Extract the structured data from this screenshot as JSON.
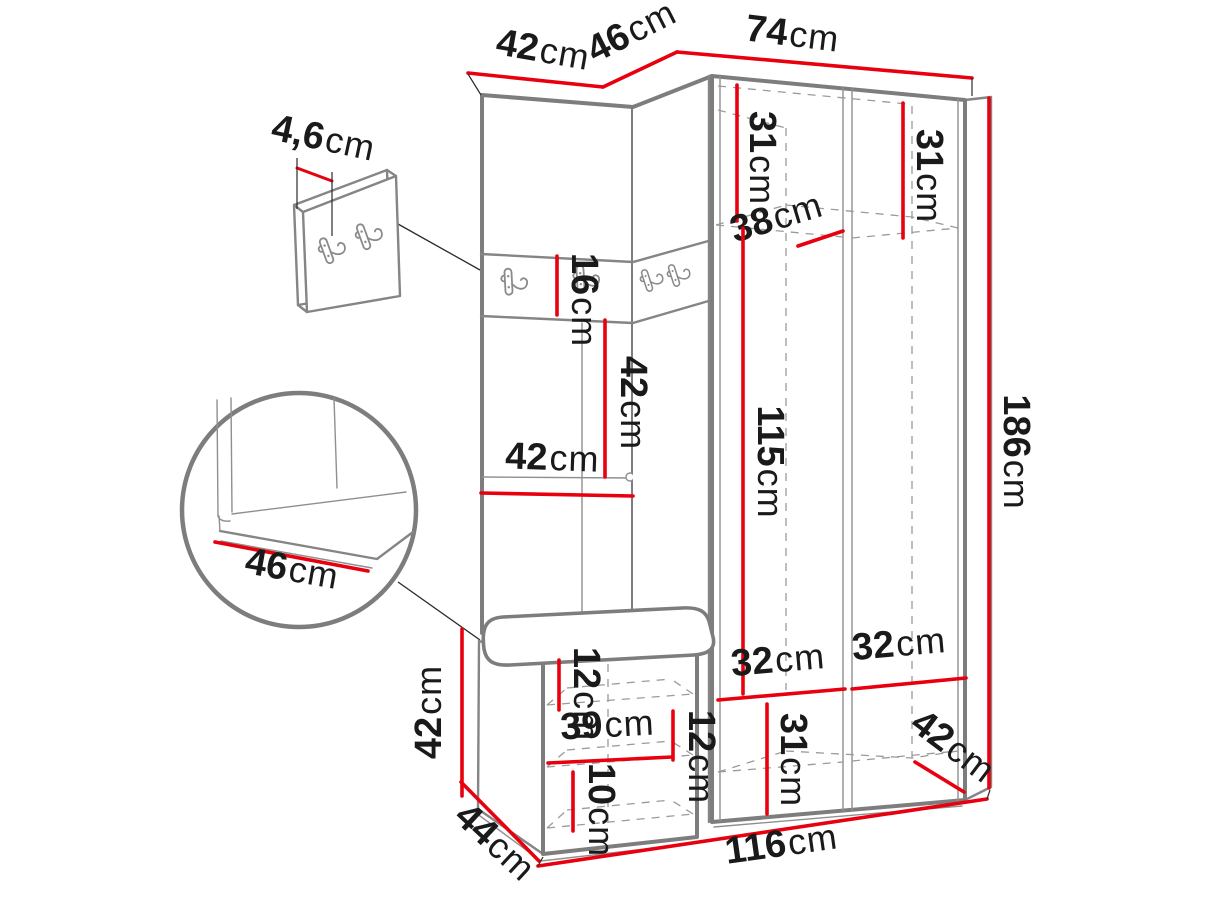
{
  "page": {
    "background": "#ffffff"
  },
  "colors": {
    "dimension_line": "#e8000f",
    "outline_gray": "#7d7d7d",
    "dashed_gray": "#9b9b9b",
    "label_text": "#1a1a1a"
  },
  "diagram": {
    "type": "furniture-dimension-drawing",
    "subject": "corner hallway wardrobe with coat hooks, padded back panel, seat bench and shoe cabinet",
    "units": "cm",
    "dimensions": {
      "top_left_width": {
        "value": "42",
        "unit": "cm"
      },
      "top_corner_width": {
        "value": "46",
        "unit": "cm"
      },
      "top_right_width": {
        "value": "74",
        "unit": "cm"
      },
      "hook_panel_thickness": {
        "value": "4,6",
        "unit": "cm"
      },
      "upper_shelf_left_height": {
        "value": "31",
        "unit": "cm"
      },
      "upper_shelf_right_height": {
        "value": "31",
        "unit": "cm"
      },
      "upper_shelf_depth": {
        "value": "38",
        "unit": "cm"
      },
      "hook_strip_height": {
        "value": "16",
        "unit": "cm"
      },
      "back_panel_height": {
        "value": "42",
        "unit": "cm"
      },
      "back_panel_width": {
        "value": "42",
        "unit": "cm"
      },
      "hanging_space_height": {
        "value": "115",
        "unit": "cm"
      },
      "total_height": {
        "value": "186",
        "unit": "cm"
      },
      "seat_detail_depth": {
        "value": "46",
        "unit": "cm"
      },
      "bench_height": {
        "value": "42",
        "unit": "cm"
      },
      "bench_top_inset": {
        "value": "12",
        "unit": "cm"
      },
      "bench_shelf_width": {
        "value": "39",
        "unit": "cm"
      },
      "bench_shelf_height": {
        "value": "12",
        "unit": "cm"
      },
      "bench_bottom_height": {
        "value": "10",
        "unit": "cm"
      },
      "lower_left_width": {
        "value": "32",
        "unit": "cm"
      },
      "lower_right_width": {
        "value": "32",
        "unit": "cm"
      },
      "lower_compartment_height": {
        "value": "31",
        "unit": "cm"
      },
      "wardrobe_depth": {
        "value": "42",
        "unit": "cm"
      },
      "bench_depth": {
        "value": "44",
        "unit": "cm"
      },
      "total_width": {
        "value": "116",
        "unit": "cm"
      }
    }
  }
}
